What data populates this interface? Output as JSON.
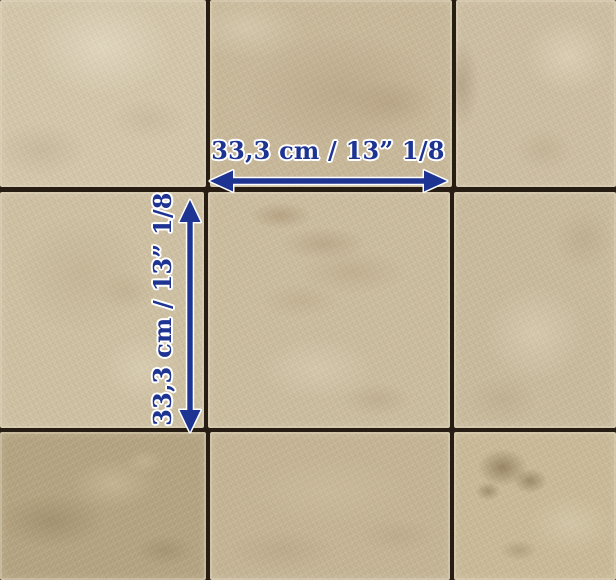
{
  "photo": {
    "subject": "Beige tumbled limestone floor tiles laid in a grid with dark joints",
    "grid": {
      "rows": 3,
      "cols": 3
    },
    "joint_color": "#271d12",
    "tile_colors": [
      "#d3c6aa",
      "#c8b899",
      "#cdbea2",
      "#cec0a2",
      "#cbbc9e",
      "#c9ba9c",
      "#b3a27f",
      "#c4b494",
      "#c9b997"
    ]
  },
  "dimensions": {
    "horizontal": {
      "label": "33,3 cm / 13” 1/8"
    },
    "vertical": {
      "label": "33,3 cm / 13” 1/8"
    },
    "color": "#1d3492",
    "outline_color": "#ffffff"
  }
}
